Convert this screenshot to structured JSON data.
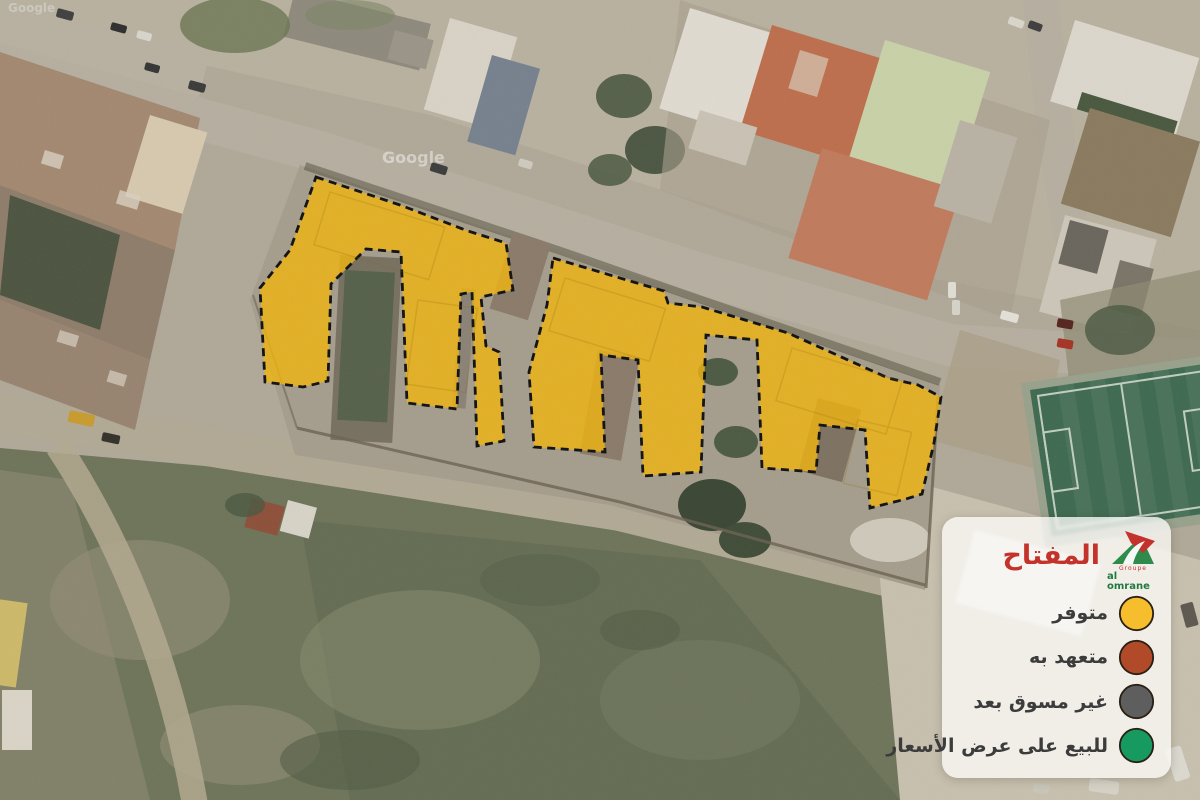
{
  "map": {
    "watermark": "Google",
    "highlight_color": "#F2B50B"
  },
  "legend": {
    "title": "المفتاح",
    "brand": {
      "groupe": "Groupe",
      "name": "al omrane"
    },
    "items": [
      {
        "label": "متوفر",
        "color": "#F6BE2C"
      },
      {
        "label": "متعهد به",
        "color": "#B04A28"
      },
      {
        "label": "غير مسوق بعد",
        "color": "#5E5E5E"
      },
      {
        "label": "للبيع على عرض الأسعار",
        "color": "#169A60"
      }
    ]
  }
}
